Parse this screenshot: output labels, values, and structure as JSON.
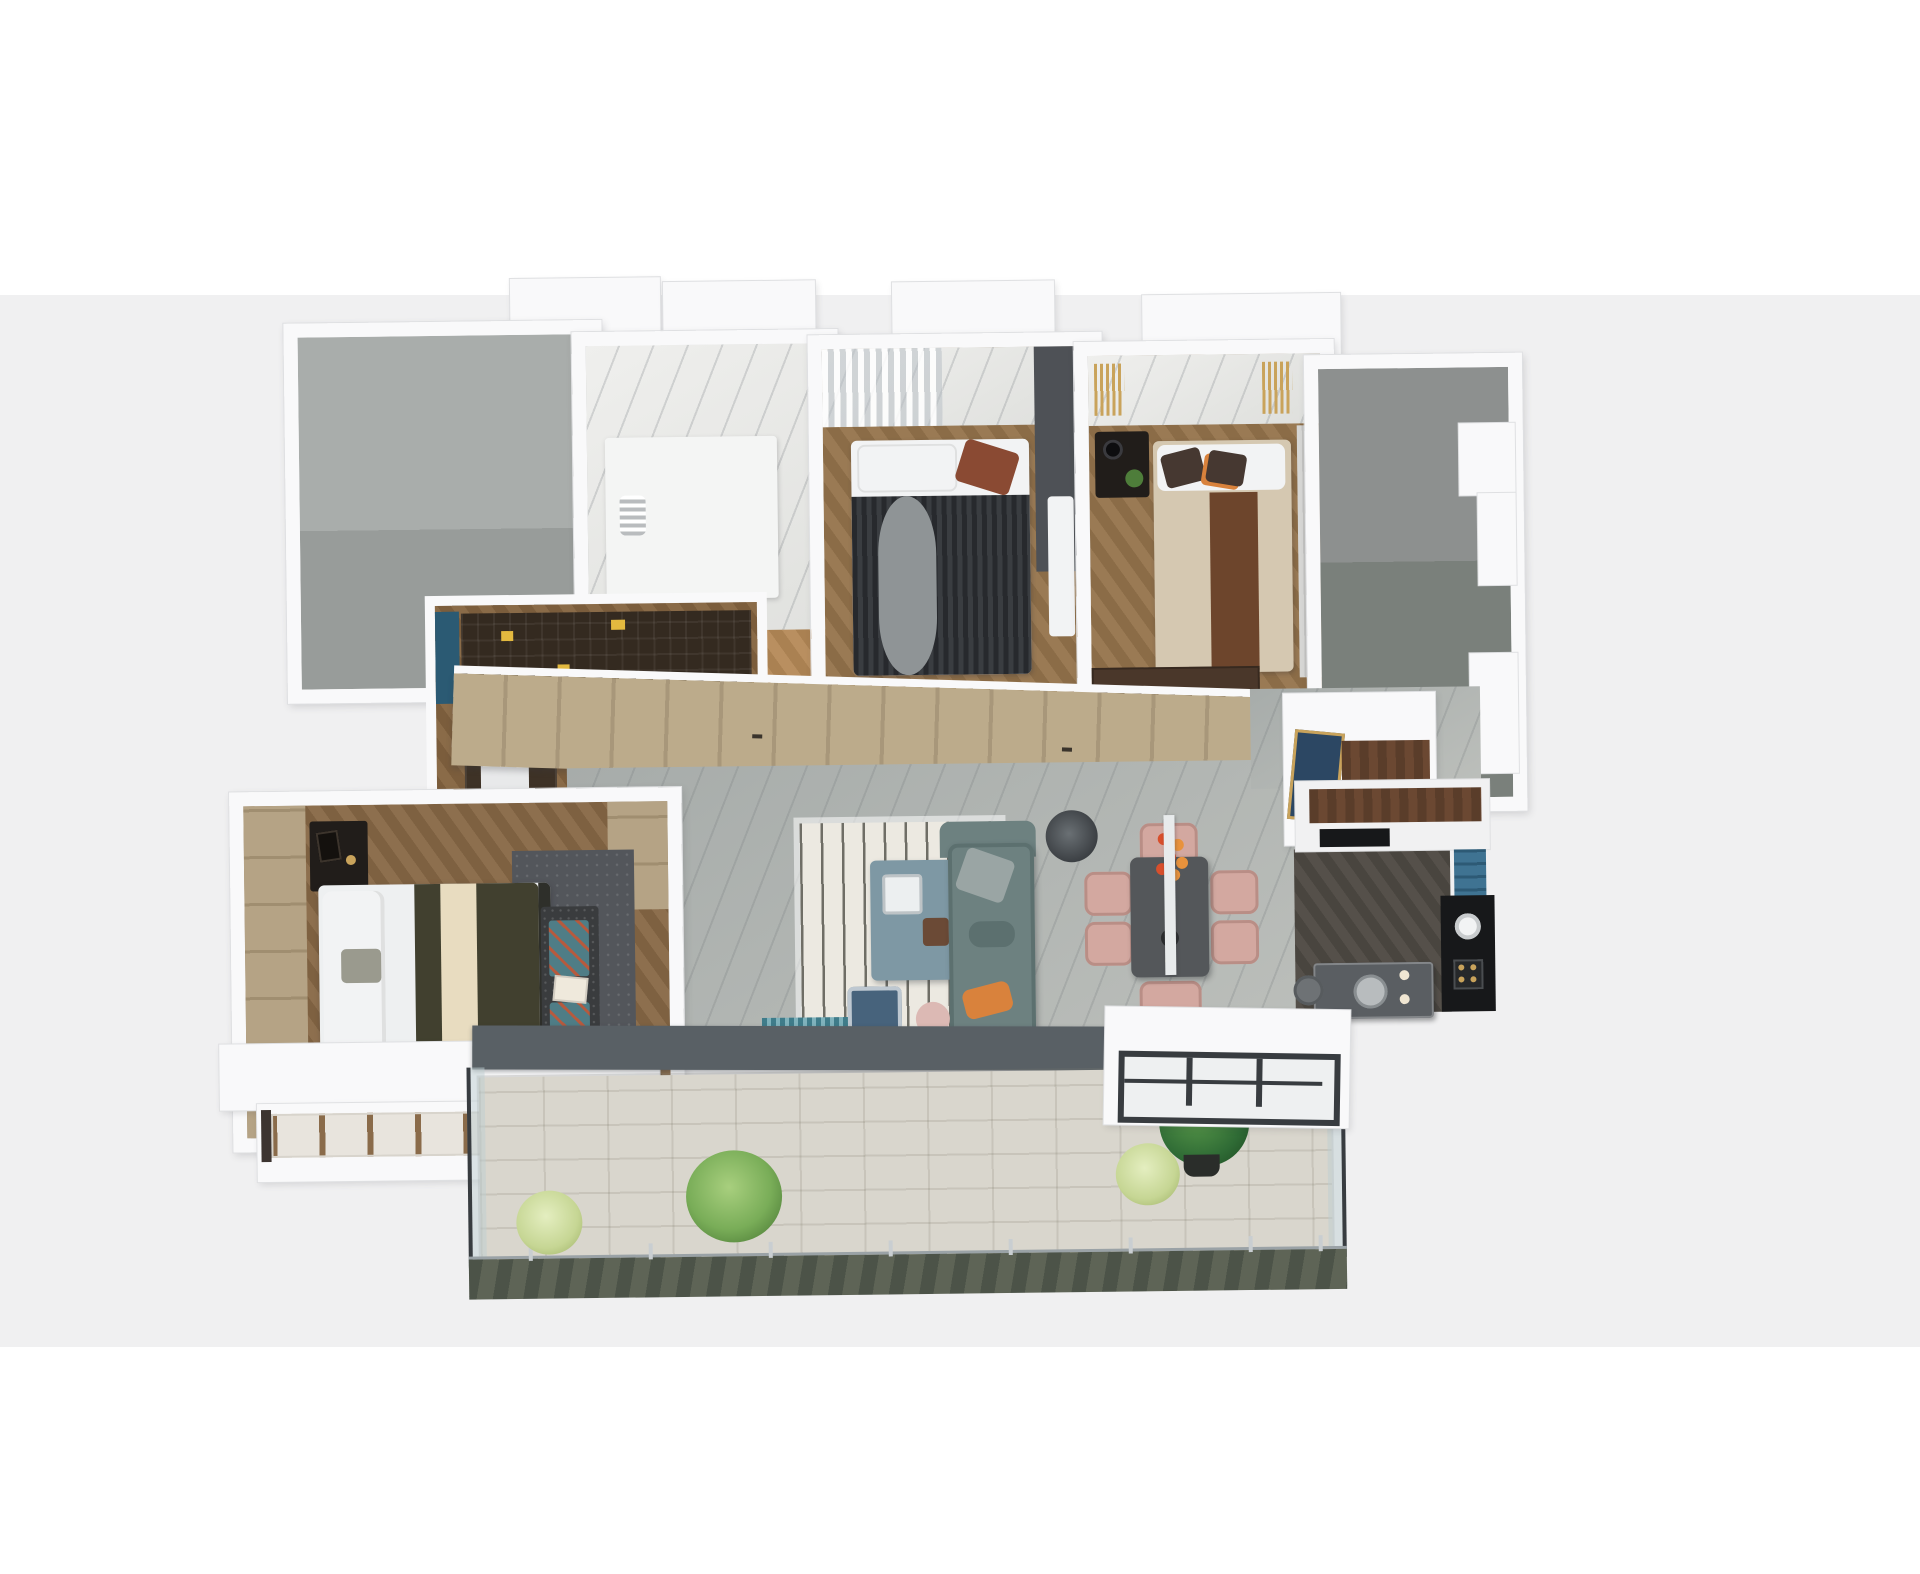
{
  "scene": {
    "type": "3d-floorplan-render",
    "description": "Top-down axonometric 3D render of a furnished apartment floor plan on a light gray backdrop",
    "background_top": "#ffffff",
    "background_band": "#f0f0f1",
    "background_bottom": "#ffffff"
  },
  "palette": {
    "bg_band": "#f0f0f1",
    "wall": "#f9f9fa",
    "wall_edge": "#dfe0e2",
    "utility_a": "#a9adab",
    "utility_b": "#989c9a",
    "stair_a": "#8d908f",
    "stair_b": "#7a807b",
    "marble_hi": "#efefed",
    "marble_lo": "#dedfdc",
    "marble_vein": "rgba(130,135,140,0.28)",
    "living_a": "#a7acaa",
    "living_b": "#bcbfbb",
    "wood_bed_a": "#9a7a54",
    "wood_bed_b": "#8b6c47",
    "wood_study_a": "#8a6b48",
    "wood_study_b": "#7b5d3c",
    "wood_master_a": "#8d6f4e",
    "wood_master_b": "#7e6141",
    "wood_bath_a": "#b98f60",
    "wood_bath_b": "#aa8152",
    "wardrobe_a": "#bcab8b",
    "wardrobe_b": "#a8977a",
    "headboard_tan_a": "#b5a385",
    "headboard_tan_b": "#a08e70",
    "rug_base": "#ece9e1",
    "rug_stripe": "#6f6e66",
    "sofa": "#6d8180",
    "sofa_dk": "#5c706f",
    "cushion_silver": "#9aa5a4",
    "pillow_orange": "#d9823c",
    "coffee_table": "#7e98a4",
    "lamp": "#3c4044",
    "armchair": "#47637c",
    "pouf": "#dcb9b4",
    "mat_teal": "#3f7c8a",
    "dining_table": "#54575a",
    "chair_pink": "#d3a8a0",
    "chair_pink_dk": "#b98e86",
    "pendant": "#e8ebec",
    "flower_red": "#d84f2c",
    "flower_orange": "#e8923c",
    "vase_dark": "#2b2d2f",
    "kitchen_a": "#55504a",
    "kitchen_b": "#49453f",
    "kitchen_black": "#17181a",
    "counter_wood": "#5a3d2a",
    "cabinet_white": "#f1f1f2",
    "shelf_blue": "#3f7392",
    "island_top": "#5a5e62",
    "stool_gray": "#6e7275",
    "console_navy": "#2c4763",
    "gold": "#c9a35b",
    "bed2_a": "#27292d",
    "bed2_b": "#3a3d41",
    "throw_gray": "#8f9496",
    "pillow_white": "#f2f3f4",
    "cushion_rust": "#8a4a33",
    "headwall_dark": "#4e5156",
    "bed3_beige": "#d5c8b1",
    "bed3_brown": "#6d452c",
    "cushion_choc": "#463831",
    "curtain_gray": "#d6d6d4",
    "dresser_wood": "#4a372a",
    "nightstand_dark": "#211d1a",
    "plant_green": "#4e7d3a",
    "master_sheet": "#eef0f1",
    "master_blanket": "#41402f",
    "master_stripe": "#e8dcc0",
    "bench_dark": "#3a3c3e",
    "chevron_teal": "#4f7d86",
    "chevron_red": "#b65a3e",
    "master_rug": "#53565b",
    "book_dark": "#342a20",
    "book_yellow": "#e3b93f",
    "desk_wood": "#3e3226",
    "office_chair": "#2c2d30",
    "accent_blue": "#2b5a73",
    "tile": "#d9d6cd",
    "tile_line": "rgba(120,115,100,0.18)",
    "parapet": "#596065",
    "rail_a": "#4c5348",
    "rail_b": "#5e6456",
    "post": "#c9ced1",
    "glass": "rgba(190,205,210,0.5)",
    "frame_dark": "#383c40",
    "plant_mid": "#79ad58",
    "plant_pale": "#c6d694",
    "plant_dark": "#2f6b35",
    "pot_dark": "#2a2d2a",
    "vanity_white": "#f4f5f4",
    "zebra_gray": "#b9bcbe"
  },
  "rooms": [
    {
      "name": "utility-room",
      "floor": "gray concrete",
      "items": [
        "empty gray floor"
      ]
    },
    {
      "name": "bathroom",
      "floor": "white marble + wood strip",
      "items": [
        "white vanity",
        "zebra figurine",
        "white chair"
      ]
    },
    {
      "name": "bedroom-2",
      "floor": "herringbone wood",
      "items": [
        "dark striped double bed",
        "gray throw",
        "white pillows",
        "marble window band with sheer curtain",
        "dark feature wall"
      ]
    },
    {
      "name": "bedroom-3",
      "floor": "herringbone wood",
      "items": [
        "beige bed with brown runner",
        "chocolate cushions",
        "gold curtains",
        "dark nightstand with plant",
        "wood dresser"
      ]
    },
    {
      "name": "stair-void",
      "floor": "gray concrete",
      "items": [
        "stepped wall notches"
      ]
    },
    {
      "name": "corridor-wardrobe",
      "floor": "wood wardrobe doors",
      "items": [
        "full-height tan wardrobe panels"
      ]
    },
    {
      "name": "study",
      "floor": "herringbone wood",
      "items": [
        "dark bookshelf with yellow books",
        "desk",
        "black office chair",
        "blue cabinet"
      ]
    },
    {
      "name": "master-bedroom",
      "floor": "herringbone wood",
      "items": [
        "white/olive bed with cream stripe",
        "chevron bench cushions",
        "dark rug",
        "nightstand",
        "tan headboard wall",
        "bay window"
      ]
    },
    {
      "name": "living-room",
      "floor": "gray marble",
      "items": [
        "striped rug",
        "teal sofa with orange pillow",
        "slate coffee table",
        "floor lamp",
        "navy armchair",
        "pink pouf",
        "teal doormat"
      ]
    },
    {
      "name": "dining-area",
      "floor": "gray marble",
      "items": [
        "dark dining table",
        "six pink chairs",
        "red-orange flowers",
        "white pendant bar"
      ]
    },
    {
      "name": "kitchen",
      "floor": "dark herringbone wood",
      "items": [
        "white cabinets with walnut counter",
        "black appliance wall",
        "blue shelf unit",
        "dark marble island with sink",
        "bar stool",
        "gas stove"
      ]
    },
    {
      "name": "entry",
      "floor": "gray marble",
      "items": [
        "white console with walnut top",
        "navy art in gold frame"
      ]
    },
    {
      "name": "main-balcony",
      "floor": "pale wood tile",
      "items": [
        "glass railing",
        "green marble parapet",
        "palm plants",
        "dark leafy plant"
      ]
    },
    {
      "name": "kitchen-balcony",
      "floor": "white",
      "items": [
        "dark framed windows"
      ]
    },
    {
      "name": "bay-window",
      "floor": "white sill",
      "items": [
        "wood mullions"
      ]
    }
  ]
}
